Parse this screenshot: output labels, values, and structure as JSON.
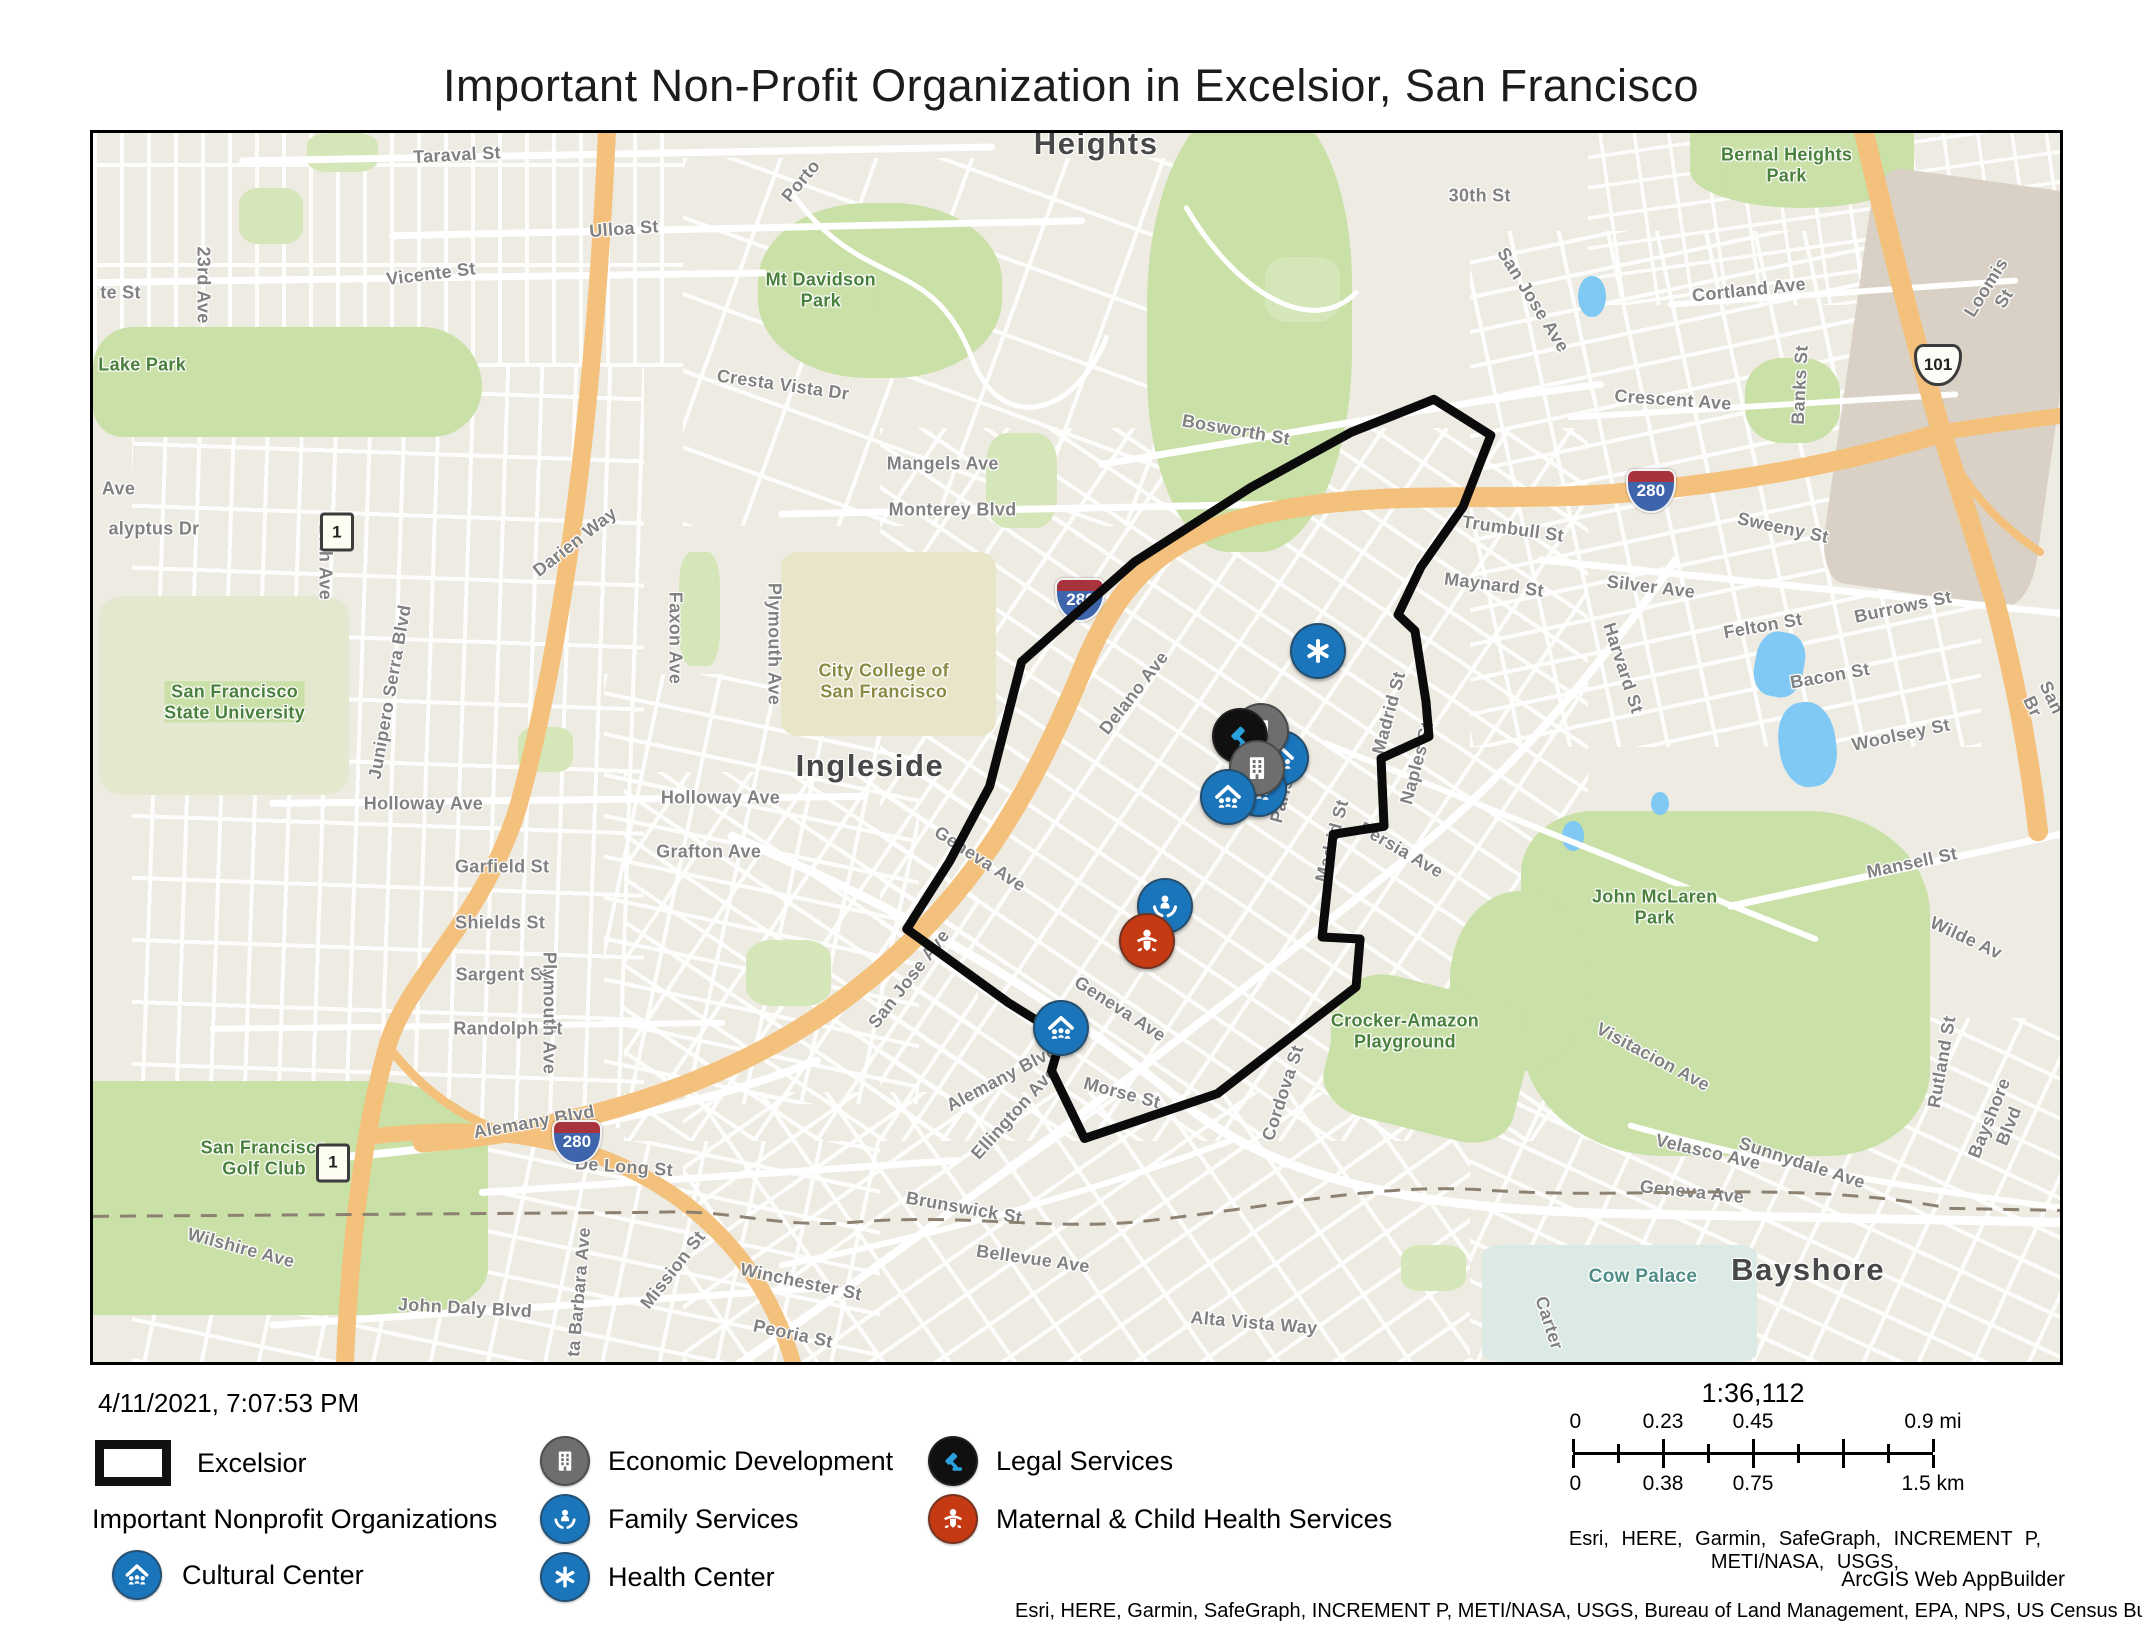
{
  "title": "Important Non-Profit Organization in Excelsior, San Francisco",
  "timestamp": "4/11/2021, 7:07:53 PM",
  "legend": {
    "excelsior_label": "Excelsior",
    "group_title": "Important Nonprofit Organizations",
    "items": [
      {
        "id": "cultural-center",
        "label": "Cultural Center",
        "color": "#1b75bb"
      },
      {
        "id": "economic-development",
        "label": "Economic Development",
        "color": "#6e6e6e"
      },
      {
        "id": "family-services",
        "label": "Family Services",
        "color": "#1b75bb"
      },
      {
        "id": "health-center",
        "label": "Health Center",
        "color": "#1b75bb"
      },
      {
        "id": "legal-services",
        "label": "Legal Services",
        "color": "#101010"
      },
      {
        "id": "maternal-child-health",
        "label": "Maternal & Child Health Services",
        "color": "#c53a12"
      }
    ]
  },
  "scalebar": {
    "ratio": "1:36,112",
    "mi_labels": [
      "0",
      "0.23",
      "0.45",
      "0.9 mi"
    ],
    "km_labels": [
      "0",
      "0.38",
      "0.75",
      "1.5 km"
    ],
    "label_positions": [
      0,
      25,
      50,
      100
    ]
  },
  "attribution": {
    "sources_line": "Esri, HERE, Garmin, SafeGraph, INCREMENT P, METI/NASA, USGS,",
    "app": "ArcGIS Web AppBuilder",
    "full_line": "Esri, HERE, Garmin, SafeGraph, INCREMENT P, METI/NASA, USGS, Bureau of Land Management, EPA, NPS, US Census Bureau, USDA |"
  },
  "map": {
    "boundary_name": "Excelsior",
    "boundary_color": "#0b0b0b",
    "boundary_points": "1343,267 1400,303 1372,375 1330,435 1307,483 1324,499 1335,570 1338,605 1290,627 1293,695 1242,703 1231,806 1269,808 1265,856 1126,963 993,1008 960,940 970,905 917,872 815,798 858,730 898,655 930,530 1043,430 1160,355 1260,300 1343,267",
    "markers": [
      {
        "type": "cultural-center",
        "x": 60.3,
        "y": 50.7
      },
      {
        "type": "economic-development",
        "x": 59.3,
        "y": 48.5
      },
      {
        "type": "legal-services",
        "x": 58.2,
        "y": 48.9
      },
      {
        "type": "cultural-center",
        "x": 59.2,
        "y": 53.2
      },
      {
        "type": "economic-development",
        "x": 59.1,
        "y": 51.5
      },
      {
        "type": "cultural-center",
        "x": 57.6,
        "y": 53.9
      },
      {
        "type": "health-center",
        "x": 62.2,
        "y": 42.0
      },
      {
        "type": "family-services",
        "x": 54.4,
        "y": 62.7
      },
      {
        "type": "maternal-child-health",
        "x": 53.5,
        "y": 65.6
      },
      {
        "type": "cultural-center",
        "x": 49.1,
        "y": 72.7
      }
    ],
    "shields": [
      {
        "type": "interstate",
        "text": "280",
        "x": 50.2,
        "y": 38.0
      },
      {
        "type": "interstate",
        "text": "280",
        "x": 79.2,
        "y": 29.1
      },
      {
        "type": "interstate",
        "text": "280",
        "x": 24.6,
        "y": 82.1
      },
      {
        "type": "us",
        "text": "101",
        "x": 93.8,
        "y": 18.9
      },
      {
        "type": "state",
        "text": "1",
        "x": 12.4,
        "y": 32.5
      },
      {
        "type": "state",
        "text": "1",
        "x": 12.2,
        "y": 83.8
      }
    ],
    "labels": [
      {
        "t": "Heights",
        "x": 51.0,
        "y": 0.9,
        "r": 0,
        "cls": "place"
      },
      {
        "t": "Ingleside",
        "x": 39.5,
        "y": 51.5,
        "r": 0,
        "cls": "place"
      },
      {
        "t": "Bayshore",
        "x": 87.2,
        "y": 92.5,
        "r": 0,
        "cls": "place"
      },
      {
        "t": "Bernal Heights\nPark",
        "x": 86.1,
        "y": 2.6,
        "r": 0,
        "cls": "park"
      },
      {
        "t": "Mt Davidson\nPark",
        "x": 37.0,
        "y": 12.8,
        "r": 0,
        "cls": "park"
      },
      {
        "t": "Lake Park",
        "x": 2.5,
        "y": 18.9,
        "r": 0,
        "cls": "park"
      },
      {
        "t": "San Francisco\nState University",
        "x": 7.2,
        "y": 46.3,
        "r": 0,
        "cls": "park"
      },
      {
        "t": "John McLaren\nPark",
        "x": 79.4,
        "y": 63.0,
        "r": 0,
        "cls": "park"
      },
      {
        "t": "Crocker-Amazon\nPlayground",
        "x": 66.7,
        "y": 73.1,
        "r": 0,
        "cls": "park"
      },
      {
        "t": "San Francisco\nGolf Club",
        "x": 8.7,
        "y": 83.4,
        "r": 0,
        "cls": "park"
      },
      {
        "t": "City College of\nSan Francisco",
        "x": 40.2,
        "y": 44.6,
        "r": 0,
        "cls": "campus"
      },
      {
        "t": "Cow Palace",
        "x": 78.8,
        "y": 93.1,
        "r": 0,
        "cls": "poi"
      },
      {
        "t": "Taraval St",
        "x": 18.5,
        "y": 1.8,
        "r": -3
      },
      {
        "t": "Porto",
        "x": 36.0,
        "y": 3.9,
        "r": -50
      },
      {
        "t": "30th St",
        "x": 70.5,
        "y": 5.1,
        "r": 0
      },
      {
        "t": "Loomis St",
        "x": 96.7,
        "y": 13.0,
        "r": -58
      },
      {
        "t": "Ulloa St",
        "x": 27.0,
        "y": 7.8,
        "r": -4
      },
      {
        "t": "Vicente St",
        "x": 17.2,
        "y": 11.5,
        "r": -7
      },
      {
        "t": "Cortland Ave",
        "x": 84.2,
        "y": 12.8,
        "r": -6
      },
      {
        "t": "Banks St",
        "x": 86.8,
        "y": 20.5,
        "r": -87
      },
      {
        "t": "23rd Ave",
        "x": 5.6,
        "y": 12.4,
        "r": 90
      },
      {
        "t": "te St",
        "x": 1.4,
        "y": 13.0,
        "r": 0
      },
      {
        "t": "Cresta Vista Dr",
        "x": 35.1,
        "y": 20.5,
        "r": 8
      },
      {
        "t": "Bosworth St",
        "x": 58.1,
        "y": 24.2,
        "r": 10
      },
      {
        "t": "San Jose Ave",
        "x": 73.2,
        "y": 13.6,
        "r": 58
      },
      {
        "t": "Crescent Ave",
        "x": 80.3,
        "y": 21.7,
        "r": 4
      },
      {
        "t": "Mangels Ave",
        "x": 43.2,
        "y": 26.9,
        "r": 0
      },
      {
        "t": "Monterey Blvd",
        "x": 43.7,
        "y": 30.7,
        "r": 0
      },
      {
        "t": "Sweeny St",
        "x": 85.9,
        "y": 32.1,
        "r": 12
      },
      {
        "t": "Ave",
        "x": 1.3,
        "y": 29.0,
        "r": 0
      },
      {
        "t": "20th Ave",
        "x": 11.8,
        "y": 34.9,
        "r": 90
      },
      {
        "t": "Darien Way",
        "x": 24.5,
        "y": 33.3,
        "r": -38
      },
      {
        "t": "Trumbull St",
        "x": 72.2,
        "y": 32.2,
        "r": 8
      },
      {
        "t": "Maynard St",
        "x": 71.2,
        "y": 36.8,
        "r": 7
      },
      {
        "t": "alyptus Dr",
        "x": 3.1,
        "y": 32.2,
        "r": 0
      },
      {
        "t": "Junipero Serra Blvd",
        "x": 15.1,
        "y": 45.5,
        "r": -80
      },
      {
        "t": "Silver Ave",
        "x": 79.2,
        "y": 36.9,
        "r": 7
      },
      {
        "t": "Harvard St",
        "x": 77.8,
        "y": 43.5,
        "r": 72
      },
      {
        "t": "Faxon Ave",
        "x": 29.6,
        "y": 41.1,
        "r": 90
      },
      {
        "t": "Plymouth Ave",
        "x": 34.6,
        "y": 41.6,
        "r": 90
      },
      {
        "t": "Felton St",
        "x": 84.9,
        "y": 40.1,
        "r": -10
      },
      {
        "t": "Burrows St",
        "x": 92.0,
        "y": 38.6,
        "r": -12
      },
      {
        "t": "Delano Ave",
        "x": 52.9,
        "y": 45.6,
        "r": -52
      },
      {
        "t": "Bacon St",
        "x": 88.3,
        "y": 44.2,
        "r": -10
      },
      {
        "t": "San Br",
        "x": 99.1,
        "y": 46.3,
        "r": 65
      },
      {
        "t": "Madrid St",
        "x": 65.9,
        "y": 47.2,
        "r": -75
      },
      {
        "t": "Paris St",
        "x": 60.6,
        "y": 53.4,
        "r": -75
      },
      {
        "t": "Madrid St",
        "x": 63.0,
        "y": 57.6,
        "r": -75
      },
      {
        "t": "Naples St",
        "x": 67.3,
        "y": 51.3,
        "r": -75
      },
      {
        "t": "Persia Ave",
        "x": 66.5,
        "y": 58.3,
        "r": 30
      },
      {
        "t": "Woolsey St",
        "x": 91.9,
        "y": 49.0,
        "r": -12
      },
      {
        "t": "Mansell St",
        "x": 92.5,
        "y": 59.4,
        "r": -12
      },
      {
        "t": "Wilde Av",
        "x": 95.2,
        "y": 65.5,
        "r": 25
      },
      {
        "t": "Holloway Ave",
        "x": 31.9,
        "y": 54.1,
        "r": 0
      },
      {
        "t": "Holloway Ave",
        "x": 16.8,
        "y": 54.6,
        "r": 0
      },
      {
        "t": "Grafton Ave",
        "x": 31.3,
        "y": 58.5,
        "r": 0
      },
      {
        "t": "Garfield St",
        "x": 20.8,
        "y": 59.7,
        "r": 0
      },
      {
        "t": "Shields St",
        "x": 20.7,
        "y": 64.3,
        "r": 0
      },
      {
        "t": "Sargent St",
        "x": 20.8,
        "y": 68.5,
        "r": 0
      },
      {
        "t": "Randolph St",
        "x": 21.1,
        "y": 72.9,
        "r": 0
      },
      {
        "t": "Geneva Ave",
        "x": 45.1,
        "y": 59.1,
        "r": 33
      },
      {
        "t": "Geneva Ave",
        "x": 52.2,
        "y": 71.3,
        "r": 33
      },
      {
        "t": "Plymouth Ave",
        "x": 23.2,
        "y": 71.6,
        "r": 90
      },
      {
        "t": "San Jose Ave",
        "x": 41.5,
        "y": 68.8,
        "r": -52
      },
      {
        "t": "Alemany Blvd",
        "x": 46.2,
        "y": 76.9,
        "r": -28
      },
      {
        "t": "Alemany Blvd",
        "x": 22.4,
        "y": 80.5,
        "r": -10
      },
      {
        "t": "Ellington Ave",
        "x": 46.8,
        "y": 79.7,
        "r": -48
      },
      {
        "t": "Morse St",
        "x": 52.3,
        "y": 78.1,
        "r": 15
      },
      {
        "t": "Cordova St",
        "x": 60.5,
        "y": 78.1,
        "r": -72
      },
      {
        "t": "Visitacion Ave",
        "x": 79.3,
        "y": 75.2,
        "r": 28
      },
      {
        "t": "Rutland St",
        "x": 94.0,
        "y": 75.6,
        "r": -80
      },
      {
        "t": "Sunnydale Ave",
        "x": 86.9,
        "y": 83.8,
        "r": 18
      },
      {
        "t": "Bayshore Blvd",
        "x": 96.9,
        "y": 80.5,
        "r": -68
      },
      {
        "t": "De Long St",
        "x": 27.0,
        "y": 84.1,
        "r": 4
      },
      {
        "t": "Brunswick St",
        "x": 44.3,
        "y": 87.5,
        "r": 10
      },
      {
        "t": "Velasco Ave",
        "x": 82.1,
        "y": 82.9,
        "r": 13
      },
      {
        "t": "Geneva Ave",
        "x": 81.3,
        "y": 86.2,
        "r": 6
      },
      {
        "t": "Wilshire Ave",
        "x": 7.5,
        "y": 90.7,
        "r": 15
      },
      {
        "t": "Mission St",
        "x": 29.5,
        "y": 92.5,
        "r": -52
      },
      {
        "t": "Winchester St",
        "x": 36.0,
        "y": 93.5,
        "r": 12
      },
      {
        "t": "Bellevue Ave",
        "x": 47.8,
        "y": 91.6,
        "r": 8
      },
      {
        "t": "John Daly Blvd",
        "x": 18.9,
        "y": 95.6,
        "r": 3
      },
      {
        "t": "ta Barbara Ave",
        "x": 24.7,
        "y": 94.3,
        "r": -85
      },
      {
        "t": "Peoria St",
        "x": 35.6,
        "y": 97.7,
        "r": 12
      },
      {
        "t": "Alta Vista Way",
        "x": 59.0,
        "y": 96.8,
        "r": 5
      },
      {
        "t": "Carter",
        "x": 74.0,
        "y": 96.8,
        "r": 72
      }
    ]
  }
}
